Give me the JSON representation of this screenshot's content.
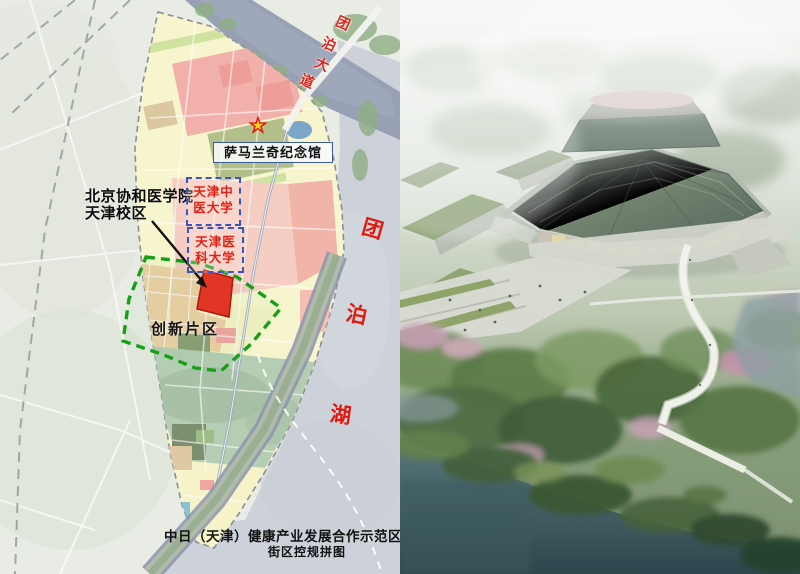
{
  "map": {
    "road_label_chars": [
      "团",
      "泊",
      "大",
      "道"
    ],
    "memorial_label": "萨马兰奇纪念馆",
    "campus_label": {
      "line1": "北京协和医学院",
      "line2": "天津校区"
    },
    "tcm_university": {
      "line1": "天津中",
      "line2": "医大学"
    },
    "medical_university": {
      "line1": "天津医",
      "line2": "科大学"
    },
    "innovation_label": "创新片区",
    "lake_label_chars": [
      "团",
      "泊",
      "湖"
    ],
    "caption": {
      "line1": "中日（天津）健康产业发展合作示范区",
      "line2": "街区控规拼图"
    }
  },
  "icons": {
    "star_glyph": "★"
  },
  "colors": {
    "label_red": "#e0241a",
    "dashed_box_blue": "#3a55c0",
    "memorial_box_border_blue": "#3c5a96",
    "innovation_boundary_green": "#17a017",
    "highlight_parcel_red": "#e93125",
    "river_blue_gray": "#98a1b3",
    "lake_gray": "#cdd1d9",
    "planning_area_yellow": "#f7f5cd",
    "caption_black": "#111111"
  }
}
